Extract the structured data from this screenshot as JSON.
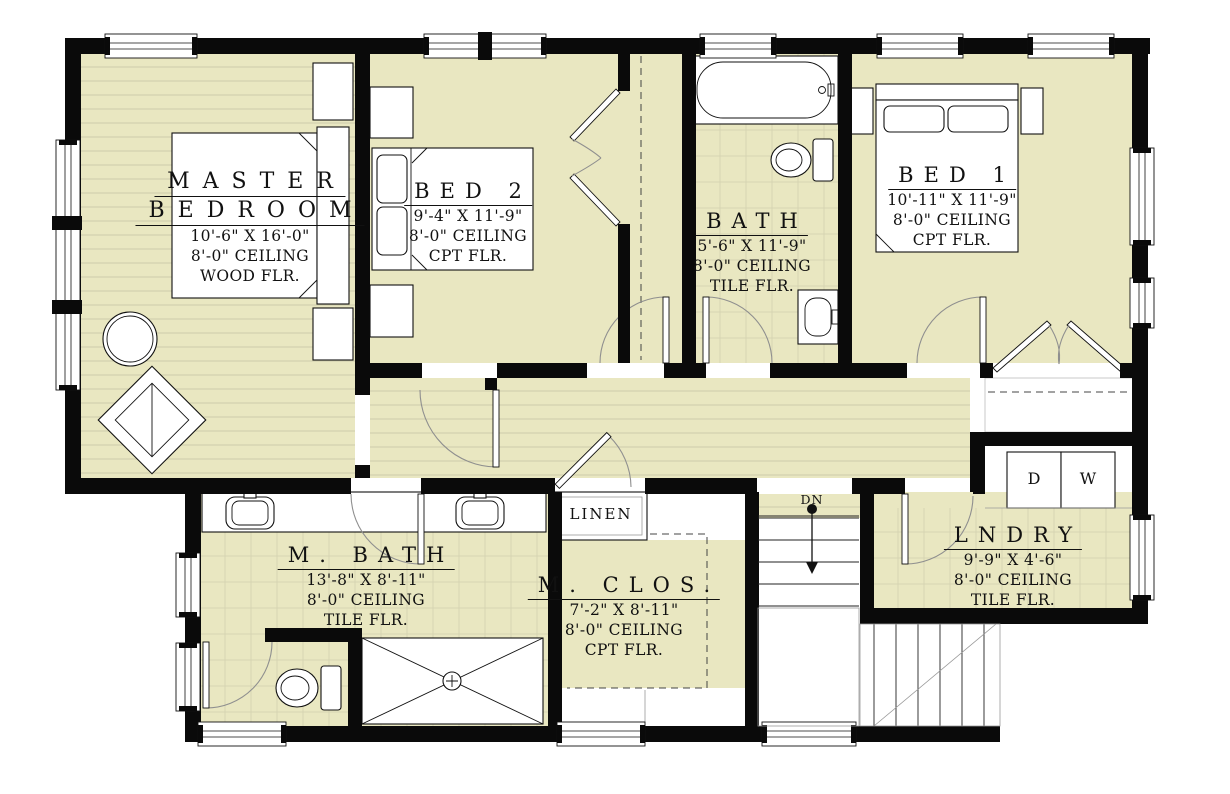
{
  "colors": {
    "floor": "#e9e7c1",
    "wall": "#0a0a0a",
    "wood_line": "#cdcbaa",
    "tile_line": "#d6d4b2",
    "door_arc": "#8f8f8f"
  },
  "rooms": {
    "master": {
      "name1": "MASTER",
      "name2": "BEDROOM",
      "dims": "10'-6\" X 16'-0\"",
      "ceiling": "8'-0\" CEILING",
      "floor": "WOOD FLR."
    },
    "bed2": {
      "name": "BED 2",
      "dims": "9'-4\" X 11'-9\"",
      "ceiling": "8'-0\" CEILING",
      "floor": "CPT FLR."
    },
    "bath": {
      "name": "BATH",
      "dims": "5'-6\" X 11'-9\"",
      "ceiling": "8'-0\" CEILING",
      "floor": "TILE FLR."
    },
    "bed1": {
      "name": "BED 1",
      "dims": "10'-11\" X 11'-9\"",
      "ceiling": "8'-0\" CEILING",
      "floor": "CPT FLR."
    },
    "mbath": {
      "name": "M. BATH",
      "dims": "13'-8\" X 8'-11\"",
      "ceiling": "8'-0\" CEILING",
      "floor": "TILE FLR."
    },
    "mclos": {
      "name": "M. CLOS.",
      "dims": "7'-2\" X 8'-11\"",
      "ceiling": "8'-0\" CEILING",
      "floor": "CPT FLR."
    },
    "lndry": {
      "name": "LNDRY",
      "dims": "9'-9\" X 4'-6\"",
      "ceiling": "8'-0\" CEILING",
      "floor": "TILE FLR."
    }
  },
  "labels": {
    "linen": "LINEN",
    "stairs_down": "DN",
    "dryer": "D",
    "washer": "W"
  }
}
